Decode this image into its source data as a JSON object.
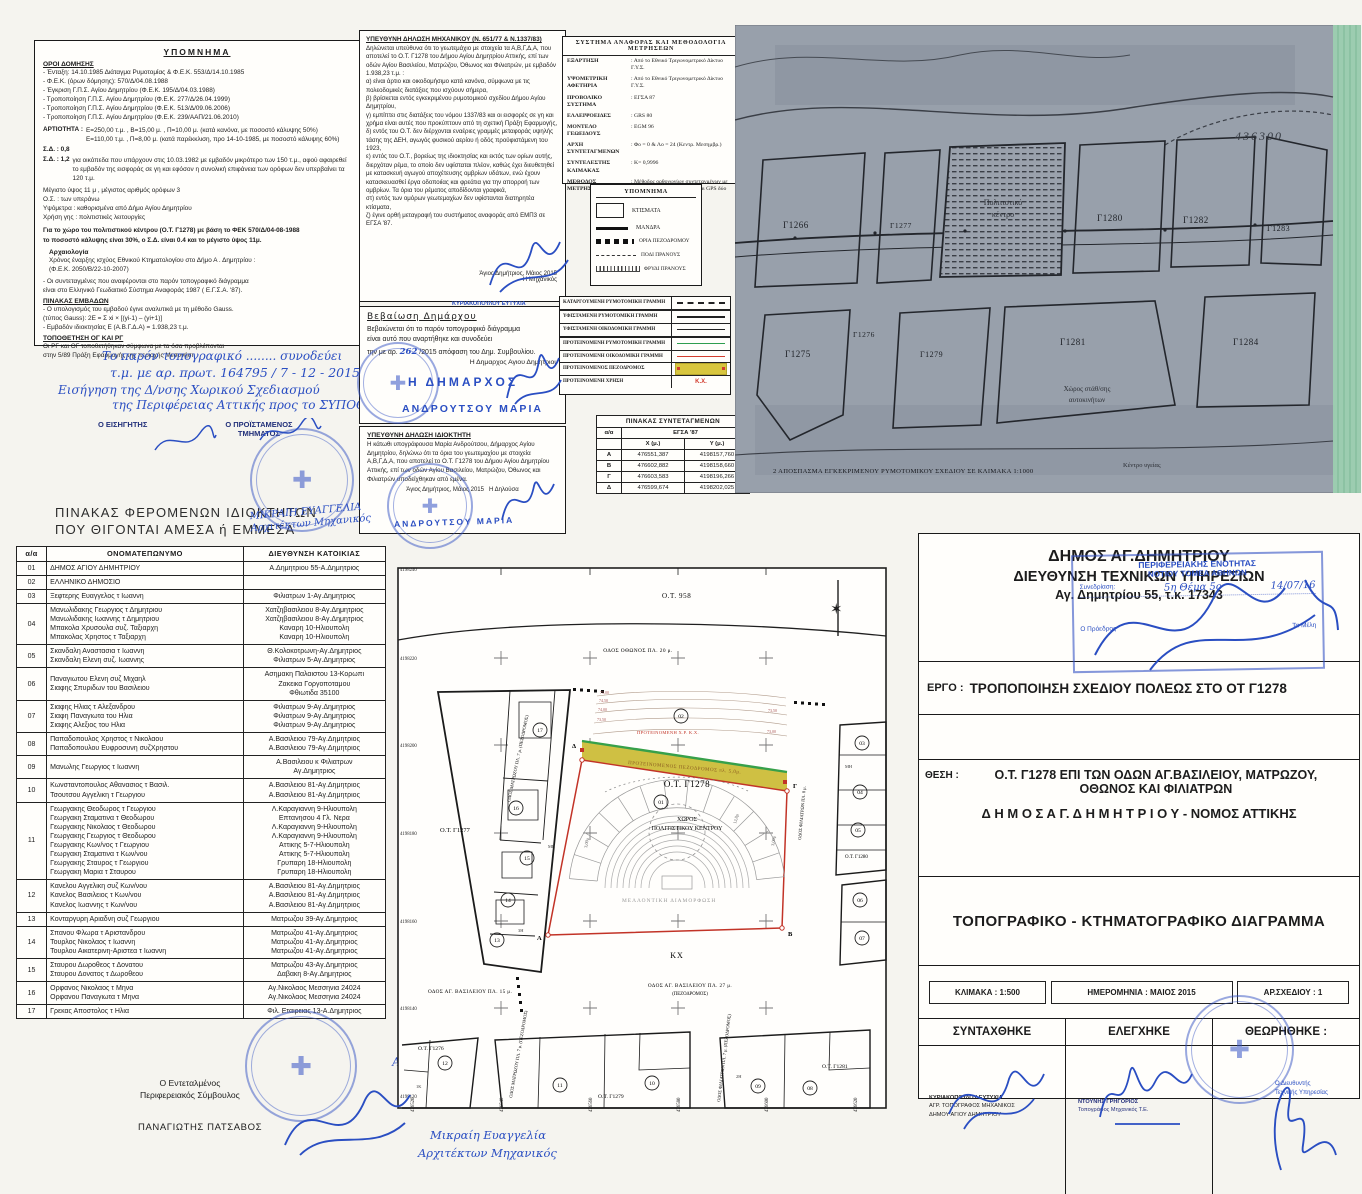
{
  "terms": {
    "title": "ΥΠΟΜΝΗΜΑ",
    "heading": "ΟΡΟΙ ΔΟΜΗΣΗΣ",
    "entries": "- Ένταξη: 14.10.1985 Διάταγμα Ρυμοτομίας  &  Φ.Ε.Κ. 553/Δ/14.10.1985\n- Φ.Ε.Κ. (όρων δόμησης): 570/Δ/04.08.1988\n- Έγκριση Γ.Π.Σ. Αγίου Δημητρίου (Φ.Ε.Κ. 195/Δ/04.03.1988)\n- Τροποποίηση Γ.Π.Σ. Αγίου Δημητρίου (Φ.Ε.Κ. 277/Δ/26.04.1999)\n- Τροποποίηση Γ.Π.Σ. Αγίου Δημητρίου (Φ.Ε.Κ. 513/Δ/09.06.2006)\n- Τροποποίηση Γ.Π.Σ. Αγίου Δημητρίου (Φ.Ε.Κ. 239/ΑΑΠ/21.06.2010)",
    "artiotita_label": "ΑΡΤΙΟΤΗΤΑ :",
    "artiotita": "Ε=250,00 τ.μ. ,  Β=15,00 μ. ,  Π=10,00 μ. (κατά κανόνα, με ποσοστό κάλυψης 50%)\nΕ=110,00 τ.μ. ,  Π=8,00 μ. (κατά παρέκκλιση, προ 14-10-1985, με ποσοστό κάλυψης 60%)",
    "sd1_label": "Σ.Δ. : 0,8",
    "sd2_label": "Σ.Δ. : 1,2",
    "sd2_text": "για οικόπεδα που υπάρχουν στις 10.03.1982 με εμβαδόν μικρότερο των 150 τ.μ., αφού αφαιρεθεί το εμβαδόν της εισφοράς σε γη και εφόσον η συνολική επιφάνεια των ορόφων δεν υπερβαίνει τα 120 τ.μ.",
    "height_rules": "Μέγιστο ύψος 11 μ , μέγιστος αριθμός ορόφων 3\nΟ.Σ. : των υπεράνω\nΥψόμετρα : καθορισμένα από Δήμο Αγίου Δημητρίου\nΧρήση γης : πολιτιστικές λειτουργίες",
    "cultural_note": "Για το χώρο του πολιτιστικού κέντρου (Ο.Τ. Γ1278) με βάση το ΦΕΚ 570/Δ/04-08-1988\nτο ποσοστό κάλυψης είναι 30%, ο Σ.Δ. είναι 0.4 και το μέγιστο ύψος 11μ.",
    "archeology_title": "Αρχαιολογία",
    "archeology": "Χρόνος έναρξης ισχύος Εθνικού Κτηματολογίου στο Δήμο Α . Δημητρίου :\n(Φ.Ε.Κ. 2050/Β/22-10-2007)",
    "egsa_note": "-  Οι συντεταγμένες που αναφέρονται στο παρόν τοπογραφικό διάγραμμα\nείναι στο Ελληνικό Γεωδαιτικό Σύστημα Αναφοράς 1987 ( Ε.Γ.Σ.Α. '87).",
    "areas_title": "ΠΙΝΑΚΑΣ ΕΜΒΑΔΩΝ",
    "areas": "- Ο υπολογισμός του εμβαδού έγινε αναλυτικά με τη μέθοδο Gauss.\n(τύπος Gauss): 2Ε = Σ xi × [(yi-1) – (yi+1)]\n- Εμβαδόν ιδιοκτησίας Ε (Α.Β.Γ.Δ.Α) = 1.938,23 τ.μ.",
    "og_title": "ΤΟΠΟΘΕΤΗΣΗ ΟΓ ΚΑΙ ΡΓ",
    "og": "Οι ΡΓ και ΟΓ τοποθετήθηκαν σύμφωνα με τα όσα προβλέπονται\nστην 5/89 Πράξη Εφαρμογής της περιοχής Μεσονήσι"
  },
  "handnote": {
    "l1": "Το παρόν τοπογραφικό ........ συνοδεύει",
    "l2": "τ.μ. με αρ. πρωτ. 164795 / 7 - 12 - 2015",
    "l3": "Εισήγηση της Δ/νσης Χωρικού Σχεδιασμού",
    "l4": "της Περιφέρειας Αττικής  προς το ΣΥΠΟΘΑ",
    "l5": "Ο ΕΙΣΗΓΗΤΗΣ",
    "l6": "Ο ΠΡΟΪΣΤΑΜΕΝΟΣ",
    "l7": "ΤΜΗΜΑΤΟΣ"
  },
  "engineer": {
    "title": "ΥΠΕΥΘΥΝΗ ΔΗΛΩΣΗ ΜΗΧΑΝΙΚΟΥ (Ν. 651/77 & Ν.1337/83)",
    "body": "Δηλώνεται υπεύθυνα ότι το γεωτεμάχιο με στοιχεία τα Α,Β,Γ,Δ,Α, που αποτελεί το Ο.Τ. Γ1278 του Δήμου Αγίου Δημητρίου Αττικής, επί των οδών Αγίου Βασιλείου, Ματρώζου, Όθωνος και Φιλιατρών, με εμβαδόν 1.938,23 τ.μ. :\nα) είναι άρτιο και οικοδομήσιμο κατά κανόνα, σύμφωνα με τις πολεοδομικές διατάξεις που ισχύουν σήμερα,\nβ) βρίσκεται εντός εγκεκριμένου ρυμοτομικού σχεδίου Δήμου Αγίου Δημητρίου,\nγ) εμπίπτει στις διατάξεις του νόμου 1337/83 και οι εισφορές σε γη και χρήμα είναι αυτές που προκύπτουν από τη σχετική Πράξη Εφαρμογής,\nδ) εντός του Ο.Τ. δεν διέρχονται εναέριες γραμμές μεταφοράς υψηλής τάσης της ΔΕΗ, αγωγός φυσικού αερίου ή οδός προϋφιστάμενη του 1923,\nε) εντός του Ο.Τ., βορείως της ιδιοκτησίας και εκτός των ορίων αυτής, διερχόταν ρέμα, το οποίο δεν υφίσταται πλέον, καθώς έχει διευθετηθεί με κατασκευή αγωγού αποχέτευσης ομβρίων υδάτων, ενώ έχουν κατασκευασθεί έργα οδοποιίας και φρεάτια για την απορροή των ομβρίων. Τα όρια του ρέματος αποδίδονται γραφικά,\nστ) εντός των ομόρων γεωτεμαχίων δεν υφίστανται διατηρητέα κτίσματα,\nζ) έγινε ορθή μεταγραφή του συστήματος αναφοράς από ΕΜΠ3 σε ΕΓΣΑ '87.",
    "place_date": "Άγιος Δημήτριος, Μάιος 2015",
    "signer": "Η Μηχανικός",
    "stamp_name": "ΚΥΡΙΑΚΟΠΟΥΛΟΥ ΕΥΤΥΧΙΑ",
    "stamp_role1": "ΑΓΡ. ΤΟΠΟΓΡΑΦΟΣ ΜΗΧΑΝΙΚΟΣ",
    "stamp_role2": "ΔΗΜΟΥ ΑΓΙΟΥ ΔΗΜΗΤΡΙΟΥ"
  },
  "mayor": {
    "title": "Βεβαίωση Δημάρχου",
    "body1": "Βεβαιώνεται ότι το παρόν τοπογραφικό διάγραμμα",
    "body2": "είναι αυτό που αναρτήθηκε και συνοδεύει",
    "body3a": "την με αρ.",
    "number": "262",
    "body3b": "/2015 απόφαση του Δημ. Συμβουλίου.",
    "signer": "Η Δημαρχος Αγιου Δημητριου",
    "stamp_line1": "Η ΔΗΜΑΡΧΟΣ",
    "stamp_line2": "ΑΝΔΡΟΥΤΣΟΥ ΜΑΡΙΑ"
  },
  "owner_decl": {
    "title": "ΥΠΕΥΘΥΝΗ ΔΗΛΩΣΗ ΙΔΙΟΚΤΗΤΗ",
    "body": "Η κάτωθι υπογράφουσα Μαρία Ανδρούτσου, Δήμαρχος Αγίου Δημητρίου, δηλώνω ότι τα όρια του γεωτεμαχίου με στοιχεία Α,Β,Γ,Δ,Α, που αποτελεί το Ο.Τ. Γ1278 του Δήμου Αγίου Δημητρίου Αττικής, επί των οδών Αγίου Βασιλείου, Ματρώζου, Όθωνος και Φιλιατρών υποδείχθηκαν από εμένα.",
    "place_date": "Άγιος Δημήτριος, Μάιος 2015",
    "signer": "Η Δηλούσα",
    "stamp_name": "ΑΝΔΡΟΥΤΣΟΥ ΜΑΡΙΑ"
  },
  "refsys": {
    "title": "ΣΥΣΤΗΜΑ ΑΝΑΦΟΡΑΣ ΚΑΙ ΜΕΘΟΔΟΛΟΓΙΑ ΜΕΤΡΗΣΕΩΝ",
    "rows": [
      {
        "label": "ΕΞΑΡΤΗΣΗ",
        "value": ": Από το Εθνικό Τριγωνομετρικό Δίκτυο Γ.Υ.Σ."
      },
      {
        "label": "ΥΨΟΜΕΤΡΙΚΗ ΑΦΕΤΗΡΙΑ",
        "value": ": Από το Εθνικό Τριγωνομετρικό Δίκτυο Γ.Υ.Σ."
      },
      {
        "label": "ΠΡΟΒΟΛΙΚΟ ΣΥΣΤΗΜΑ",
        "value": ": ΕΓΣΑ 87"
      },
      {
        "label": "ΕΛΛΕΙΨΟΕΙΔΕΣ",
        "value": ": GRS 80"
      },
      {
        "label": "ΜΟΝΤΕΛΟ ΓΕΩΕΙΔΟΥΣ",
        "value": ": EGM 96"
      },
      {
        "label": "ΑΡΧΗ ΣΥΝΤΕΤΑΓΜΕΝΩΝ",
        "value": ": Φο = 0  &  Λο = 24 (Κεντρ. Μεσημβρ.)"
      },
      {
        "label": "ΣΥΝΤΕΛΕΣΤΗΣ ΚΛΙΜΑΚΑΣ",
        "value": ": Κ= 0,9996"
      },
      {
        "label": "ΜΕΘΟΔΟΣ ΜΕΤΡΗΣΕΩΝ",
        "value": ": Μέθοδος ορθογωνίων συντεταγμένων με χρήση γεωδαιτικού σταθμού και GPS δύο συχνοτήτων"
      }
    ]
  },
  "legend": {
    "title": "ΥΠΟΜΝΗΜΑ",
    "items": [
      "ΚΤΙΣΜΑΤΑ",
      "ΜΑΝΔΡΑ",
      "ΟΡΙΑ ΠΕΖΟΔΡΟΜΟΥ",
      "ΠΟΔΙ ΠΡΑΝΟΥΣ",
      "ΦΡΥΔΙ ΠΡΑΝΟΥΣ"
    ]
  },
  "linelegend": {
    "rows": [
      "ΚΑΤΑΡΓΟΥΜΕΝΗ ΡΥΜΟΤΟΜΙΚΗ ΓΡΑΜΜΗ",
      "ΥΦΙΣΤΑΜΕΝΗ ΡΥΜΟΤΟΜΙΚΗ ΓΡΑΜΜΗ",
      "ΥΦΙΣΤΑΜΕΝΗ ΟΙΚΟΔΟΜΙΚΗ ΓΡΑΜΜΗ",
      "ΠΡΟΤΕΙΝΟΜΕΝΗ ΡΥΜΟΤΟΜΙΚΗ ΓΡΑΜΜΗ",
      "ΠΡΟΤΕΙΝΟΜΕΝΗ ΟΙΚΟΔΟΜΙΚΗ ΓΡΑΜΜΗ",
      "ΠΡΟΤΕΙΝΟΜΕΝΟΣ ΠΕΖΟΔΡΟΜΟΣ",
      "ΠΡΟΤΕΙΝΟΜΕΝΗ ΧΡΗΣΗ"
    ],
    "kx": "Κ.Χ."
  },
  "coords": {
    "title": "ΠΙΝΑΚΑΣ ΣΥΝΤΕΤΑΓΜΕΝΩΝ",
    "col_id": "α/α",
    "system": "ΕΓΣΑ '87",
    "col_x": "X (μ.)",
    "col_y": "Y (μ.)",
    "rows": [
      {
        "id": "Α",
        "x": "476551,387",
        "y": "4198157,760"
      },
      {
        "id": "Β",
        "x": "476602,882",
        "y": "4198158,660"
      },
      {
        "id": "Γ",
        "x": "476603,583",
        "y": "4198196,266"
      },
      {
        "id": "Δ",
        "x": "476599,674",
        "y": "4198202,025"
      }
    ]
  },
  "map": {
    "grid_number": "436300",
    "caption": "2  ΑΠΟΣΠΑΣΜΑ ΕΓΚΕΚΡΙΜΕΝΟΥ ΡΥΜΟΤΟΜΙΚΟΥ ΣΧΕΔΙΟΥ ΣΕ ΚΛΙΜΑΚΑ 1:1000",
    "blocks": [
      "Γ1266",
      "Γ1277",
      "Γ1280",
      "Γ1282",
      "Γ1283",
      "Γ1275",
      "Γ1276",
      "Γ1279",
      "Γ1281",
      "Γ1284"
    ],
    "cultural_line1": "Πολιτιστικό",
    "cultural_line2": "κέντρο",
    "parking_line1": "Χώρος στάθ/σης",
    "parking_line2": "αυτοκινήτων",
    "health_label": "Κέντρο υγείας"
  },
  "owners": {
    "title_line1": "ΠΙΝΑΚΑΣ ΦΕΡΟΜΕΝΩΝ ΙΔΙΟΚΤΗΤΩΝ",
    "title_line2": "ΠΟΥ ΘΙΓΟΝΤΑΙ ΑΜΕΣΑ ή ΕΜΜΕΣΑ",
    "col_id": "α/α",
    "col_name": "ΟΝΟΜΑΤΕΠΩΝΥΜΟ",
    "col_addr": "ΔΙΕΥΘΥΝΣΗ ΚΑΤΟΙΚΙΑΣ",
    "rows": [
      {
        "id": "01",
        "names": "ΔΗΜΟΣ ΑΓΙΟΥ ΔΗΜΗΤΡΙΟΥ",
        "addresses": "Α.Δημητριου 55-Α.Δημητριος"
      },
      {
        "id": "02",
        "names": "ΕΛΛΗΝΙΚΟ ΔΗΜΟΣΙΟ",
        "addresses": ""
      },
      {
        "id": "03",
        "names": "Ξεφτερης Ευαγγελος τ Ιωαννη",
        "addresses": "Φιλιατρων 1-Αγ.Δημητριος"
      },
      {
        "id": "04",
        "names": "Μανωλιδακης Γεωργιος τ Δημητριου\nΜανωλιδακης Ιωαννης τ Δημητριου\nΜπακολα Χρυσουλα συζ. Ταξιαρχη\nΜπακολας Χρηστος τ Ταξιαρχη",
        "addresses": "Χατζηβασιλειου 8-Αγ.Δημητριος\nΧατζηβασιλειου 8-Αγ.Δημητριος\nΚαναρη 10-Ηλιουπολη\nΚαναρη 10-Ηλιουπολη"
      },
      {
        "id": "05",
        "names": "Σκανδαλη Αναστασια τ Ιωαννη\nΣκανδαλη Ελενη συζ. Ιωαννης",
        "addresses": "Θ.Κολοκοτρωνη-Αγ.Δημητριος\nΦιλιατρων 5-Αγ.Δημητριος"
      },
      {
        "id": "06",
        "names": "Παναγιωτου Ελενη συζ Μιχαηλ\nΣιαφης Σπυριδων του Βασιλειου",
        "addresses": "Ασημακη Παλαιστου 13-Κορωπι\nΖακεικα Γοργοποταμου\nΦθιωτιδα 35100"
      },
      {
        "id": "07",
        "names": "Σιαφης Ηλιας τ Αλεξανδρου\nΣιαφη Παναγιωτα του Ηλια\nΣιαφης Αλεξιος του Ηλια",
        "addresses": "Φιλιατρων 9-Αγ.Δημητριος\nΦιλιατρων 9-Αγ.Δημητριος\nΦιλιατρων 9-Αγ.Δημητριος"
      },
      {
        "id": "08",
        "names": "Παπαδοπουλος Χρηστος τ Νικολαου\nΠαπαδοπουλου Ευφροσυνη συζΧρηστου",
        "addresses": "Α.Βασιλειου 79-Αγ.Δημητριος\nΑ.Βασιλειου 79-Αγ.Δημητριος"
      },
      {
        "id": "09",
        "names": "Μανωλης Γεωργιος τ Ιωαννη",
        "addresses": "Α.Βασιλειου κ Φιλιατρων\nΑγ.Δημητριος"
      },
      {
        "id": "10",
        "names": "Κωνσταντοπουλος Αθανασιος τ Βασιλ.\nΤσουτσου Αγγελικη τ Γεωργιου",
        "addresses": "Α.Βασιλειου 81-Αγ.Δημητριος\nΑ.Βασιλειου 81-Αγ.Δημητριος"
      },
      {
        "id": "11",
        "names": "Γεωργακης Θεοδωρος τ Γεωργιου\nΓεωργακη Σταματινα τ Θεοδωρου\nΓεωργακης Νικολαος τ Θεοδωρου\nΓεωργακης Γεωργιος τ Θεοδωρου\nΓεωργακης Κων/νος τ Γεωργιου\nΓεωργακη Σταματινα τ Κων/νου\nΓεωργακης Σταυρος τ Γεωργιου\nΓεωργακη Μαρια τ Σταυρου",
        "addresses": "Λ.Καραγιαννη 9-Ηλιουπολη\nΕπτανησου 4  Γλ. Νερα\nΛ.Καραγιαννη 9-Ηλιουπολη\nΛ.Καραγιαννη 9-Ηλιουπολη\nΑττικης 5-7-Ηλιουπολη\nΑττικης 5-7-Ηλιουπολη\nΓρυπαρη 18-Ηλιουπολη\nΓρυπαρη 18-Ηλιουπολη"
      },
      {
        "id": "12",
        "names": "Κανελου Αγγελικη συζ Κων/νου\nΚανελος Βασιλειος τ Κων/νου\nΚανελος Ιωαννης τ Κων/νου",
        "addresses": "Α.Βασιλειου 81-Αγ.Δημητριος\nΑ.Βασιλειου 81-Αγ.Δημητριος\nΑ.Βασιλειου 81-Αγ.Δημητριος"
      },
      {
        "id": "13",
        "names": "Κονταργυρη Αριαδνη συζ Γεωργιου",
        "addresses": "Ματρωζου 39-Αγ.Δημητριος"
      },
      {
        "id": "14",
        "names": "Σπανου Φλωρα τ Αριστανδρου\nΤουρλος Νικολαος τ Ιωαννη\nΤουρλου Αικατερινη-Αριστεα τ Ιωαννη",
        "addresses": "Ματρωζου 41-Αγ.Δημητριος\nΜατρωζου 41-Αγ.Δημητριος\nΜατρωζου 41-Αγ.Δημητριος"
      },
      {
        "id": "15",
        "names": "Σταυρου Δωροθεος τ Δονατου\nΣταυρου Δονατος τ Δωροθεου",
        "addresses": "Ματρωζου 43-Αγ.Δημητριος\nΔαβακη 8-Αγ.Δημητριος"
      },
      {
        "id": "16",
        "names": "Ορφανος Νικολαος τ Μηνα\nΟρφανου Παναγιωτα τ Μηνα",
        "addresses": "Αγ.Νικολαος Μεσσηνια 24024\nΑγ.Νικολαος Μεσσηνια 24024"
      },
      {
        "id": "17",
        "names": "Γρεκας Αποστολος τ Ηλια",
        "addresses": "Φιλ. Εταιρειας 13-Α.Δημητριος"
      }
    ]
  },
  "plan": {
    "ot_958": "Ο.Τ. 958",
    "odos_othonos": "ΟΔΟΣ ΟΘΩΝΟΣ ΠΛ. 20 μ.",
    "ot_g1278": "Ο.Τ. Γ1278",
    "xoros": "ΧΩΡΟΣ",
    "politistikou": "ΠΟΛΙΤΙΣΤΙΚΟΥ ΚΕΝΤΡΟΥ",
    "mellontiki": "ΜΕΛΛΟΝΤΙΚΗ ΔΙΑΜΟΡΦΩΣΗ",
    "kx": "ΚΧ",
    "ot_g1277": "Ο.Τ. Γ1277",
    "ot_g1276": "Ο.Τ. Γ1276",
    "ot_g1279": "Ο.Τ. Γ1279",
    "ot_g1281": "Ο.Τ. Γ1281",
    "ot_g1280": "Ο.Τ. Γ1280",
    "odos_vasileiou_15": "ΟΔΟΣ ΑΓ. ΒΑΣΙΛΕΙΟΥ ΠΛ. 15 μ.",
    "odos_vasileiou_27": "ΟΔΟΣ ΑΓ. ΒΑΣΙΛΕΙΟΥ ΠΛ. 27 μ.",
    "pezodromos": "(ΠΕΖΟΔΡΟΜΟΣ)",
    "odos_matrozou": "ΟΔΟΣ ΜΑΤΡΩΖΟΥ ΠΛ. 7 μ. (ΠΕΖΟΔΡΟΜΟΣ)",
    "odos_filiatron_8": "ΟΔΟΣ ΦΙΛΙΑΤΡΩΝ ΠΛ. 8 μ.",
    "odos_filiatron_7": "ΟΔΟΣ ΦΙΛΙΑΤΡΩΝ ΠΛ. 7 μ. (ΠΕΖΟΔΡΟΜΟΣ)",
    "proposed_strip": "ΠΡΟΤΕΙΝΟΜΕΝΟΣ ΠΕΖΟΔΡΟΜΟΣ πλ. 5,0μ.",
    "proposed_use": "ΠΡΟΤΕΙΝΟΜΕΝΗ Χ.Ρ. Κ.Χ.",
    "north_icon": "✶",
    "corners": {
      "a": "Α",
      "b": "Β",
      "g": "Γ",
      "d": "Δ"
    },
    "circled": {
      "c01": "01",
      "c02": "02",
      "c03": "03",
      "c04": "04",
      "c05": "05",
      "c06": "06",
      "c07": "07",
      "c08": "08",
      "c09": "09",
      "c10": "10",
      "c11": "11",
      "c12": "12",
      "c13": "13",
      "c14": "14",
      "c15": "15",
      "c16": "16",
      "c17": "17"
    },
    "y_labels": [
      "4198240",
      "4198220",
      "4198200",
      "4198180",
      "4198160",
      "4198140",
      "4198120"
    ],
    "x_labels": [
      "476520",
      "476540",
      "476560",
      "476580",
      "476600",
      "476620"
    ],
    "contours": [
      "75,00",
      "74,50",
      "74,00",
      "73,50",
      "73,00"
    ],
    "dims": [
      "3,00μ",
      "3,00μ",
      "12,8μ"
    ],
    "storeys": [
      "ΜΗ",
      "3Η",
      "2Η",
      "1Κ"
    ]
  },
  "titleblock": {
    "org1": "ΔΗΜΟΣ ΑΓ.ΔΗΜΗΤΡΙΟΥ",
    "org2": "ΔΙΕΥΘΥΝΣΗ ΤΕΧΝΙΚΩΝ ΥΠΗΡΕΣΙΩΝ",
    "org3": "Αγ. Δημητρίου 55, τ.κ. 17343",
    "stamp": {
      "l1": "ΠΕΡΙΦΕΡΕΙΑΚΗΣ ΕΝΟΤΗΤΑΣ",
      "l2": "ΝΟΤΙΟΥ ΤΟΜΕΑ ΑΘΗΝΩΝ",
      "session": "Συνεδρίαση:",
      "hand1": "5η  Θέμα 5ο",
      "hand2": "14/07/16",
      "president": "Ο Πρόεδρος",
      "members": "Τα Μέλη"
    },
    "ergo_label": "ΕΡΓΟ :",
    "ergo": "ΤΡΟΠΟΠΟΙΗΣΗ ΣΧΕΔΙΟΥ ΠΟΛΕΩΣ ΣΤΟ ΟΤ Γ1278",
    "thesi_label": "ΘΕΣΗ :",
    "thesi1": "Ο.Τ. Γ1278 ΕΠΙ ΤΩΝ ΟΔΩΝ ΑΓ.ΒΑΣΙΛΕΙΟΥ, ΜΑΤΡΩΖΟΥ,",
    "thesi2": "ΟΘΩΝΟΣ ΚΑΙ ΦΙΛΙΑΤΡΩΝ",
    "dimos": "Δ Η Μ Ο Σ   Α Γ.  Δ Η Μ Η Τ Ρ Ι Ο Υ - ΝΟΜΟΣ ΑΤΤΙΚΗΣ",
    "doc_title": "ΤΟΠΟΓΡΑΦΙΚΟ - ΚΤΗΜΑΤΟΓΡΑΦΙΚΟ ΔΙΑΓΡΑΜΜΑ",
    "scale": "ΚΛΙΜΑΚΑ : 1:500",
    "date": "ΗΜΕΡΟΜΗΝΙΑ : ΜΑΙΟΣ 2015",
    "sheet": "ΑΡ.ΣΧΕΔΙΟΥ : 1",
    "col1": "ΣΥΝΤΑΧΘΗΚΕ",
    "col2": "ΕΛΕΓΧΗΚΕ",
    "col3": "ΘΕΩΡΗΘΗΚΕ :",
    "synt_name": "ΚΥΡΙΑΚΟΠΟΥΛΟΥ ΕΥΤΥΧΙΑ",
    "synt_role1": "ΑΓΡ. ΤΟΠΟΓΡΑΦΟΣ ΜΗΧΑΝΙΚΟΣ",
    "synt_role2": "ΔΗΜΟΥ ΑΓΙΟΥ ΔΗΜΗΤΡΙΟΥ",
    "eleg_name": "ΝΤΟΥΝΗΣ ΓΡΗΓΟΡΙΟΣ",
    "eleg_role": "Τοπογράφος Μηχανικός Τ.Ε.",
    "theor_role1": "Ο Διευθυντής",
    "theor_role2": "Τεχνικής Υπηρεσίας"
  },
  "signoff": {
    "delegate1": "Ο Εντεταλμένος",
    "delegate2": "Περιφερειακός Σύμβουλος",
    "delegate_name": "ΠΑΝΑΓΙΩΤΗΣ ΠΑΤΣΑΒΟΣ",
    "copy1": "Ακριβές αντίγραφο",
    "copy2": "13. 2. 2017",
    "copy3": "Μικραίη Ευαγγελία",
    "copy4": "Αρχιτέκτων Μηχανικός",
    "arch1": "ΜΙΚΡΑΙΗ ΕΥΑΓΓΕΛΙΑ",
    "arch2": "Αρχιτέκτων Μηχανικός"
  }
}
